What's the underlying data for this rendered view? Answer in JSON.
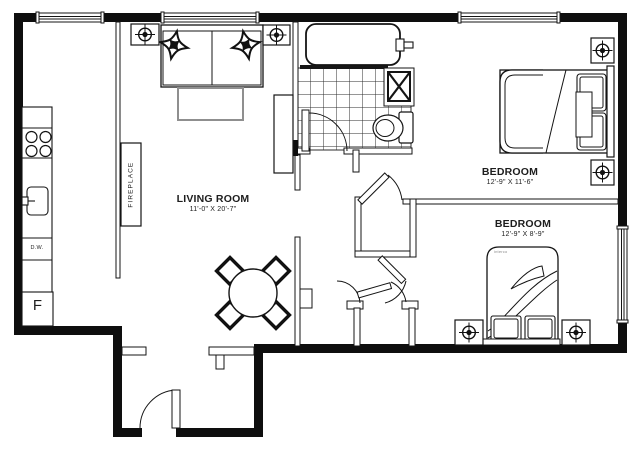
{
  "plan": {
    "rooms": {
      "living_room": {
        "name": "LIVING ROOM",
        "dimensions": "11'-0\" X 20'-7\""
      },
      "bedroom_1": {
        "name": "BEDROOM",
        "dimensions": "12'-9\" X 11'-6\""
      },
      "bedroom_2": {
        "name": "BEDROOM",
        "dimensions": "12'-9\" X 8'-9\""
      }
    },
    "labels": {
      "fireplace": "FIREPLACE",
      "dishwasher": "D.W.",
      "fridge": "F",
      "bed_watermark": "interco"
    },
    "fixtures": [
      "sofa",
      "throw pillows",
      "coffee table",
      "console table",
      "dining table",
      "dining chairs",
      "fireplace",
      "range",
      "kitchen sink",
      "dishwasher",
      "refrigerator",
      "bathtub",
      "shower unit",
      "toilet",
      "double bed",
      "single bed",
      "nightstands"
    ],
    "icons": {
      "ceiling_light": "crosshair-target-circle",
      "shower_vent": "boxed-x"
    },
    "counts": {
      "ceiling_lights": 6,
      "doors": 6,
      "windows": 4
    },
    "colors": {
      "walls": "#0e0e0e",
      "lines": "#161616",
      "coffee_table": "#8f8f8f",
      "background": "#ffffff"
    }
  }
}
